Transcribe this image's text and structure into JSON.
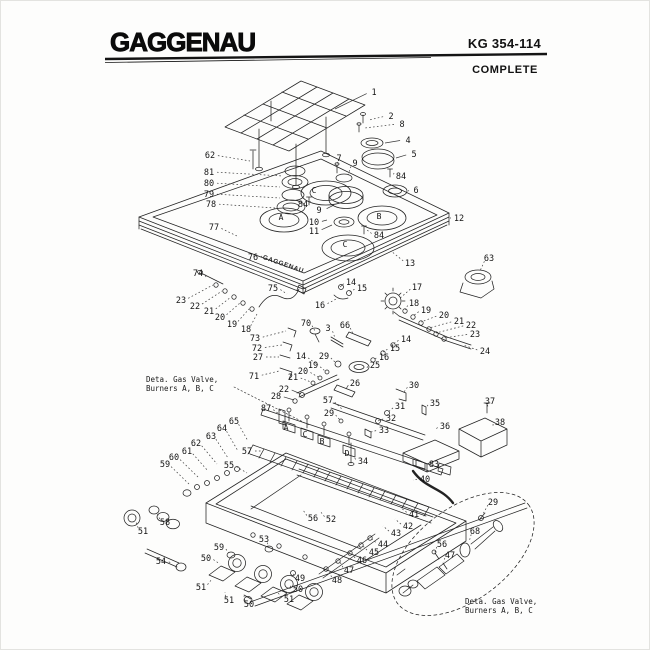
{
  "header": {
    "brand": "GAGGENAU",
    "model": "KG 354-114",
    "subtitle": "COMPLETE"
  },
  "diagram": {
    "watermark": "GAGGENAU",
    "notes": [
      {
        "x": 145,
        "y": 381,
        "lines": [
          "Deta. Gas Valve,",
          "Burners A, B, C"
        ]
      },
      {
        "x": 464,
        "y": 603,
        "lines": [
          "Deta. Gas Valve,",
          "Burners A, B, C"
        ]
      }
    ],
    "part_letters": [
      {
        "t": "C",
        "x": 313,
        "y": 189
      },
      {
        "t": "A",
        "x": 280,
        "y": 216
      },
      {
        "t": "B",
        "x": 378,
        "y": 215
      },
      {
        "t": "C",
        "x": 344,
        "y": 243
      },
      {
        "t": "A",
        "x": 285,
        "y": 426
      },
      {
        "t": "C",
        "x": 304,
        "y": 433
      },
      {
        "t": "B",
        "x": 321,
        "y": 440
      },
      {
        "t": "D",
        "x": 346,
        "y": 452
      }
    ],
    "labels": [
      {
        "t": "1",
        "x": 373,
        "y": 91,
        "tx": 334,
        "ty": 108,
        "solid": true
      },
      {
        "t": "2",
        "x": 390,
        "y": 115,
        "tx": 368,
        "ty": 119
      },
      {
        "t": "8",
        "x": 401,
        "y": 123,
        "tx": 364,
        "ty": 127
      },
      {
        "t": "4",
        "x": 407,
        "y": 139,
        "tx": 384,
        "ty": 142,
        "solid": true
      },
      {
        "t": "5",
        "x": 413,
        "y": 153,
        "tx": 395,
        "ty": 157,
        "solid": true
      },
      {
        "t": "84",
        "x": 400,
        "y": 175,
        "tx": 393,
        "ty": 172
      },
      {
        "t": "6",
        "x": 415,
        "y": 189,
        "tx": 408,
        "ty": 190
      },
      {
        "t": "7",
        "x": 338,
        "y": 157,
        "tx": 336,
        "ty": 167
      },
      {
        "t": "9",
        "x": 354,
        "y": 162,
        "tx": 347,
        "ty": 174
      },
      {
        "t": "62",
        "x": 209,
        "y": 154,
        "tx": 249,
        "ty": 160
      },
      {
        "t": "81",
        "x": 208,
        "y": 171,
        "tx": 282,
        "ty": 175
      },
      {
        "t": "80",
        "x": 208,
        "y": 182,
        "tx": 279,
        "ty": 186
      },
      {
        "t": "79",
        "x": 208,
        "y": 193,
        "tx": 279,
        "ty": 197
      },
      {
        "t": "78",
        "x": 210,
        "y": 203,
        "tx": 274,
        "ty": 207
      },
      {
        "t": "77",
        "x": 213,
        "y": 226,
        "tx": 238,
        "ty": 236
      },
      {
        "t": "76",
        "x": 252,
        "y": 256,
        "tx": 261,
        "ty": 255
      },
      {
        "t": "84",
        "x": 302,
        "y": 203,
        "tx": 309,
        "ty": 200
      },
      {
        "t": "9",
        "x": 318,
        "y": 209,
        "tx": 333,
        "ty": 204,
        "solid": true
      },
      {
        "t": "10",
        "x": 313,
        "y": 221,
        "tx": 326,
        "ty": 219,
        "solid": true
      },
      {
        "t": "11",
        "x": 313,
        "y": 230,
        "tx": 331,
        "ty": 224,
        "solid": true
      },
      {
        "t": "84",
        "x": 378,
        "y": 234,
        "tx": 366,
        "ty": 229
      },
      {
        "t": "12",
        "x": 458,
        "y": 217,
        "tx": 449,
        "ty": 217,
        "solid": true
      },
      {
        "t": "13",
        "x": 409,
        "y": 262,
        "tx": 390,
        "ty": 250
      },
      {
        "t": "63",
        "x": 488,
        "y": 257,
        "tx": 479,
        "ty": 270
      },
      {
        "t": "17",
        "x": 416,
        "y": 286,
        "tx": 398,
        "ty": 298
      },
      {
        "t": "18",
        "x": 413,
        "y": 302,
        "tx": 404,
        "ty": 309
      },
      {
        "t": "19",
        "x": 425,
        "y": 309,
        "tx": 412,
        "ty": 315
      },
      {
        "t": "20",
        "x": 443,
        "y": 314,
        "tx": 420,
        "ty": 321
      },
      {
        "t": "21",
        "x": 458,
        "y": 320,
        "tx": 428,
        "ty": 327
      },
      {
        "t": "22",
        "x": 470,
        "y": 324,
        "tx": 435,
        "ty": 332
      },
      {
        "t": "23",
        "x": 474,
        "y": 333,
        "tx": 443,
        "ty": 337
      },
      {
        "t": "24",
        "x": 484,
        "y": 350,
        "tx": 462,
        "ty": 344
      },
      {
        "t": "74",
        "x": 197,
        "y": 272,
        "tx": 205,
        "ty": 276,
        "solid": true
      },
      {
        "t": "23",
        "x": 180,
        "y": 299,
        "tx": 212,
        "ty": 284
      },
      {
        "t": "22",
        "x": 194,
        "y": 305,
        "tx": 221,
        "ty": 290
      },
      {
        "t": "21",
        "x": 208,
        "y": 310,
        "tx": 230,
        "ty": 296
      },
      {
        "t": "20",
        "x": 219,
        "y": 316,
        "tx": 239,
        "ty": 302
      },
      {
        "t": "19",
        "x": 231,
        "y": 323,
        "tx": 248,
        "ty": 308
      },
      {
        "t": "18",
        "x": 245,
        "y": 328,
        "tx": 256,
        "ty": 313
      },
      {
        "t": "75",
        "x": 272,
        "y": 287,
        "tx": 286,
        "ty": 293
      },
      {
        "t": "14",
        "x": 350,
        "y": 281,
        "tx": 339,
        "ty": 286,
        "solid": true
      },
      {
        "t": "15",
        "x": 361,
        "y": 287,
        "tx": 347,
        "ty": 292
      },
      {
        "t": "16",
        "x": 319,
        "y": 304,
        "tx": 337,
        "ty": 297
      },
      {
        "t": "70",
        "x": 305,
        "y": 322,
        "tx": 314,
        "ty": 330
      },
      {
        "t": "3",
        "x": 327,
        "y": 327,
        "tx": 334,
        "ty": 337
      },
      {
        "t": "66",
        "x": 344,
        "y": 324,
        "tx": 352,
        "ty": 333
      },
      {
        "t": "73",
        "x": 254,
        "y": 337,
        "tx": 285,
        "ty": 330
      },
      {
        "t": "72",
        "x": 256,
        "y": 347,
        "tx": 281,
        "ty": 344
      },
      {
        "t": "27",
        "x": 257,
        "y": 356,
        "tx": 278,
        "ty": 356
      },
      {
        "t": "71",
        "x": 253,
        "y": 375,
        "tx": 278,
        "ty": 370
      },
      {
        "t": "14",
        "x": 300,
        "y": 355,
        "tx": 317,
        "ty": 364
      },
      {
        "t": "29",
        "x": 323,
        "y": 355,
        "tx": 335,
        "ty": 362
      },
      {
        "t": "19",
        "x": 312,
        "y": 364,
        "tx": 324,
        "ty": 370
      },
      {
        "t": "20",
        "x": 302,
        "y": 370,
        "tx": 317,
        "ty": 376
      },
      {
        "t": "21",
        "x": 292,
        "y": 376,
        "tx": 310,
        "ty": 381
      },
      {
        "t": "26",
        "x": 354,
        "y": 382,
        "tx": 345,
        "ty": 388,
        "solid": true
      },
      {
        "t": "25",
        "x": 374,
        "y": 364,
        "tx": 366,
        "ty": 367
      },
      {
        "t": "14",
        "x": 405,
        "y": 338,
        "tx": 392,
        "ty": 343
      },
      {
        "t": "15",
        "x": 394,
        "y": 347,
        "tx": 382,
        "ty": 351
      },
      {
        "t": "16",
        "x": 383,
        "y": 356,
        "tx": 372,
        "ty": 359
      },
      {
        "t": "57",
        "x": 327,
        "y": 399,
        "tx": 342,
        "ty": 409
      },
      {
        "t": "87",
        "x": 265,
        "y": 407,
        "tx": 278,
        "ty": 413
      },
      {
        "t": "28",
        "x": 275,
        "y": 395,
        "tx": 293,
        "ty": 399,
        "solid": true
      },
      {
        "t": "22",
        "x": 283,
        "y": 388,
        "tx": 300,
        "ty": 393,
        "solid": true
      },
      {
        "t": "29",
        "x": 328,
        "y": 412,
        "tx": 339,
        "ty": 419
      },
      {
        "t": "31",
        "x": 399,
        "y": 405,
        "tx": 386,
        "ty": 412
      },
      {
        "t": "32",
        "x": 390,
        "y": 417,
        "tx": 377,
        "ty": 420
      },
      {
        "t": "33",
        "x": 383,
        "y": 429,
        "tx": 370,
        "ty": 431
      },
      {
        "t": "30",
        "x": 413,
        "y": 384,
        "tx": 403,
        "ty": 391
      },
      {
        "t": "35",
        "x": 434,
        "y": 402,
        "tx": 425,
        "ty": 407
      },
      {
        "t": "36",
        "x": 444,
        "y": 425,
        "tx": 434,
        "ty": 429
      },
      {
        "t": "37",
        "x": 489,
        "y": 400,
        "tx": 487,
        "ty": 406
      },
      {
        "t": "38",
        "x": 499,
        "y": 421,
        "tx": 492,
        "ty": 425
      },
      {
        "t": "83",
        "x": 433,
        "y": 463,
        "tx": 425,
        "ty": 463
      },
      {
        "t": "40",
        "x": 424,
        "y": 478,
        "tx": 412,
        "ty": 479
      },
      {
        "t": "34",
        "x": 362,
        "y": 460,
        "tx": 353,
        "ty": 456
      },
      {
        "t": "41",
        "x": 413,
        "y": 513,
        "tx": 400,
        "ty": 507
      },
      {
        "t": "42",
        "x": 407,
        "y": 525,
        "tx": 394,
        "ty": 518
      },
      {
        "t": "43",
        "x": 395,
        "y": 532,
        "tx": 382,
        "ty": 525
      },
      {
        "t": "44",
        "x": 382,
        "y": 543,
        "tx": 371,
        "ty": 538
      },
      {
        "t": "45",
        "x": 373,
        "y": 551,
        "tx": 362,
        "ty": 545
      },
      {
        "t": "46",
        "x": 361,
        "y": 559,
        "tx": 351,
        "ty": 553
      },
      {
        "t": "47",
        "x": 348,
        "y": 569,
        "tx": 339,
        "ty": 561
      },
      {
        "t": "48",
        "x": 336,
        "y": 579,
        "tx": 327,
        "ty": 569
      },
      {
        "t": "49",
        "x": 299,
        "y": 577,
        "tx": 292,
        "ty": 571
      },
      {
        "t": "50",
        "x": 297,
        "y": 588,
        "tx": 288,
        "ty": 583
      },
      {
        "t": "51",
        "x": 288,
        "y": 598,
        "tx": 277,
        "ty": 592
      },
      {
        "t": "50",
        "x": 248,
        "y": 603,
        "tx": 243,
        "ty": 595
      },
      {
        "t": "51",
        "x": 228,
        "y": 599,
        "tx": 224,
        "ty": 591
      },
      {
        "t": "51",
        "x": 200,
        "y": 586,
        "tx": 211,
        "ty": 578
      },
      {
        "t": "50",
        "x": 205,
        "y": 557,
        "tx": 219,
        "ty": 563
      },
      {
        "t": "59",
        "x": 218,
        "y": 546,
        "tx": 228,
        "ty": 552
      },
      {
        "t": "53",
        "x": 263,
        "y": 538,
        "tx": 267,
        "ty": 546
      },
      {
        "t": "54",
        "x": 160,
        "y": 560,
        "tx": 170,
        "ty": 562
      },
      {
        "t": "51",
        "x": 142,
        "y": 530,
        "tx": 135,
        "ty": 521
      },
      {
        "t": "58",
        "x": 164,
        "y": 521,
        "tx": 156,
        "ty": 512
      },
      {
        "t": "55",
        "x": 228,
        "y": 464,
        "tx": 246,
        "ty": 472
      },
      {
        "t": "57",
        "x": 246,
        "y": 450,
        "tx": 262,
        "ty": 450
      },
      {
        "t": "65",
        "x": 233,
        "y": 420,
        "tx": 247,
        "ty": 440
      },
      {
        "t": "64",
        "x": 221,
        "y": 427,
        "tx": 237,
        "ty": 450
      },
      {
        "t": "63",
        "x": 210,
        "y": 435,
        "tx": 227,
        "ty": 457
      },
      {
        "t": "62",
        "x": 195,
        "y": 442,
        "tx": 216,
        "ty": 463
      },
      {
        "t": "61",
        "x": 186,
        "y": 450,
        "tx": 207,
        "ty": 470
      },
      {
        "t": "60",
        "x": 173,
        "y": 456,
        "tx": 198,
        "ty": 477
      },
      {
        "t": "59",
        "x": 164,
        "y": 463,
        "tx": 189,
        "ty": 484
      },
      {
        "t": "52",
        "x": 330,
        "y": 518,
        "tx": 319,
        "ty": 510
      },
      {
        "t": "56",
        "x": 312,
        "y": 517,
        "tx": 302,
        "ty": 509
      },
      {
        "t": "68",
        "x": 474,
        "y": 530,
        "tx": 468,
        "ty": 541
      },
      {
        "t": "56",
        "x": 441,
        "y": 543,
        "tx": 434,
        "ty": 551
      },
      {
        "t": "47",
        "x": 449,
        "y": 554,
        "tx": 443,
        "ty": 561
      },
      {
        "t": "29",
        "x": 492,
        "y": 501,
        "tx": 482,
        "ty": 513
      }
    ]
  }
}
